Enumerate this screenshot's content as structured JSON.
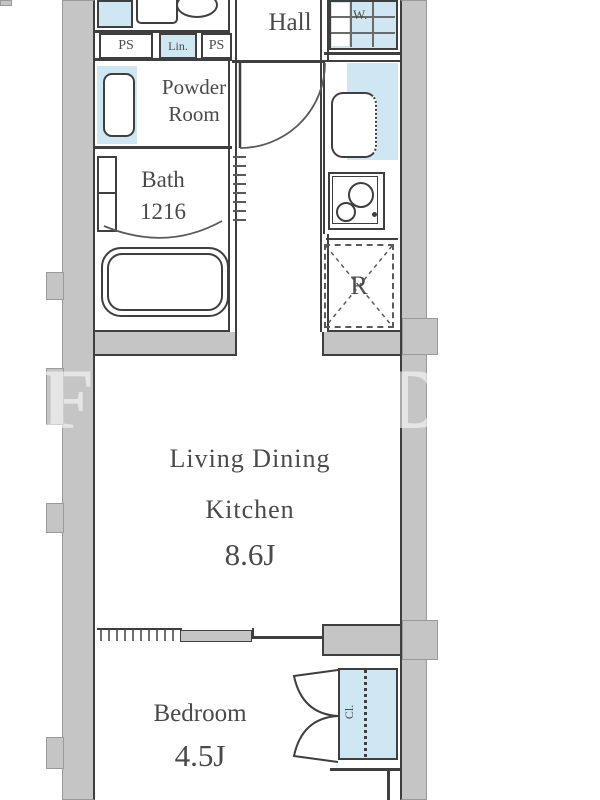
{
  "plan": {
    "title": "apartment-floor-plan",
    "rooms": {
      "hall": "Hall",
      "powder_line1": "Powder",
      "powder_line2": "Room",
      "bath_name": "Bath",
      "bath_size": "1216",
      "ldk_line1": "Living Dining",
      "ldk_line2": "Kitchen",
      "ldk_size": "8.6J",
      "bedroom_name": "Bedroom",
      "bedroom_size": "4.5J"
    },
    "labels": {
      "ps_left": "PS",
      "lin": "Lin.",
      "ps_right": "PS",
      "washer": "W.",
      "refrigerator": "R",
      "closet": "Cl."
    },
    "watermark": {
      "left": "F",
      "right": "D"
    },
    "colors": {
      "wall": "#c5c5c5",
      "wall_edge": "#9a9a9a",
      "line": "#3f3f3f",
      "fixture_blue": "#cfe7f3",
      "text": "#4a4a4a"
    }
  }
}
